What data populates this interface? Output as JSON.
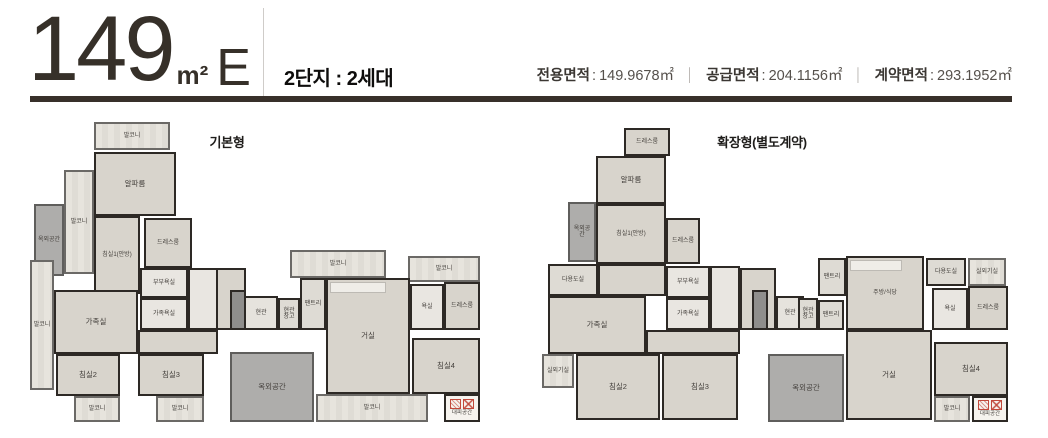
{
  "header": {
    "area_number": "149",
    "area_unit": "m²",
    "type_letter": "E",
    "subtitle": "2단지 : 2세대",
    "colon": ":",
    "divider": "│",
    "area_info": [
      {
        "label": "전용면적",
        "value": "149.9678㎡"
      },
      {
        "label": "공급면적",
        "value": "204.1156㎡"
      },
      {
        "label": "계약면적",
        "value": "293.1952㎡"
      }
    ],
    "accent_color": "#38302a"
  },
  "colors": {
    "wall": "#2d2925",
    "floor": "#d8d4cc",
    "balcony": "#e4e1da",
    "bath": "#e9e6e1",
    "outdoor": "#aeadab",
    "utility": "#dedbd4",
    "shaft": "#8f8e8c",
    "evac_red": "#c2493b"
  },
  "plans": [
    {
      "id": "basic",
      "title": "기본형",
      "x": 30,
      "y": 118,
      "w": 460,
      "h": 312,
      "title_x": 147,
      "title_y": 14,
      "title_w": 100,
      "rooms": [
        {
          "x": 186,
          "y": 150,
          "w": 30,
          "h": 62,
          "type": "floor"
        },
        {
          "x": 108,
          "y": 212,
          "w": 80,
          "h": 24,
          "type": "floor"
        },
        {
          "x": 158,
          "y": 150,
          "w": 30,
          "h": 62,
          "type": "bath"
        },
        {
          "x": 200,
          "y": 172,
          "w": 16,
          "h": 40,
          "type": "shaft"
        },
        {
          "label": "발코니",
          "x": 64,
          "y": 4,
          "w": 76,
          "h": 28,
          "type": "balcony",
          "small": true
        },
        {
          "label": "알파룸",
          "x": 64,
          "y": 34,
          "w": 82,
          "h": 64,
          "type": "floor"
        },
        {
          "label": "발코니",
          "x": 34,
          "y": 52,
          "w": 30,
          "h": 104,
          "type": "balcony",
          "small": true
        },
        {
          "label": "옥외공간",
          "x": 4,
          "y": 86,
          "w": 30,
          "h": 72,
          "type": "outdoor",
          "small": true
        },
        {
          "label": "침실1(안방)",
          "x": 64,
          "y": 98,
          "w": 46,
          "h": 78,
          "type": "floor",
          "small": true
        },
        {
          "label": "드레스룸",
          "x": 114,
          "y": 100,
          "w": 48,
          "h": 50,
          "type": "floor",
          "small": true
        },
        {
          "label": "부부욕실",
          "x": 110,
          "y": 150,
          "w": 48,
          "h": 30,
          "type": "bath",
          "small": true
        },
        {
          "label": "가족욕실",
          "x": 110,
          "y": 180,
          "w": 48,
          "h": 32,
          "type": "bath",
          "small": true
        },
        {
          "label": "가족실",
          "x": 24,
          "y": 172,
          "w": 84,
          "h": 64,
          "type": "floor"
        },
        {
          "label": "발코니",
          "x": 0,
          "y": 142,
          "w": 24,
          "h": 130,
          "type": "balcony",
          "small": true
        },
        {
          "label": "침실2",
          "x": 26,
          "y": 236,
          "w": 64,
          "h": 42,
          "type": "floor"
        },
        {
          "label": "침실3",
          "x": 108,
          "y": 236,
          "w": 66,
          "h": 42,
          "type": "floor"
        },
        {
          "label": "발코니",
          "x": 44,
          "y": 278,
          "w": 46,
          "h": 26,
          "type": "balcony",
          "small": true
        },
        {
          "label": "발코니",
          "x": 126,
          "y": 278,
          "w": 48,
          "h": 26,
          "type": "balcony",
          "small": true
        },
        {
          "label": "현관",
          "x": 214,
          "y": 178,
          "w": 34,
          "h": 34,
          "type": "entry",
          "small": true
        },
        {
          "label": "현관창고",
          "x": 248,
          "y": 180,
          "w": 22,
          "h": 32,
          "type": "utility",
          "small": true
        },
        {
          "label": "팬트리",
          "x": 270,
          "y": 160,
          "w": 26,
          "h": 52,
          "type": "utility",
          "small": true
        },
        {
          "label": "발코니",
          "x": 260,
          "y": 132,
          "w": 96,
          "h": 28,
          "type": "balcony",
          "small": true
        },
        {
          "label": "발코니",
          "x": 378,
          "y": 138,
          "w": 72,
          "h": 26,
          "type": "balcony",
          "small": true
        },
        {
          "label": "욕실",
          "x": 380,
          "y": 166,
          "w": 34,
          "h": 46,
          "type": "bath",
          "small": true
        },
        {
          "label": "드레스룸",
          "x": 414,
          "y": 164,
          "w": 36,
          "h": 48,
          "type": "floor",
          "small": true
        },
        {
          "label": "거실",
          "x": 296,
          "y": 160,
          "w": 84,
          "h": 116,
          "type": "floor",
          "accent": "counter"
        },
        {
          "label": "침실4",
          "x": 382,
          "y": 220,
          "w": 68,
          "h": 56,
          "type": "floor"
        },
        {
          "label": "옥외공간",
          "x": 200,
          "y": 234,
          "w": 84,
          "h": 70,
          "type": "outdoor"
        },
        {
          "label": "발코니",
          "x": 286,
          "y": 276,
          "w": 112,
          "h": 28,
          "type": "balcony",
          "small": true
        },
        {
          "label": "대피공간",
          "x": 414,
          "y": 276,
          "w": 36,
          "h": 28,
          "type": "evac",
          "small": true
        }
      ]
    },
    {
      "id": "extended",
      "title": "확장형(별도계약)",
      "x": 540,
      "y": 118,
      "w": 472,
      "h": 312,
      "title_x": 142,
      "title_y": 14,
      "title_w": 160,
      "rooms": [
        {
          "x": 200,
          "y": 150,
          "w": 36,
          "h": 62,
          "type": "floor"
        },
        {
          "x": 106,
          "y": 212,
          "w": 94,
          "h": 24,
          "type": "floor"
        },
        {
          "x": 170,
          "y": 148,
          "w": 30,
          "h": 64,
          "type": "bath"
        },
        {
          "x": 58,
          "y": 146,
          "w": 68,
          "h": 32,
          "type": "floor"
        },
        {
          "x": 212,
          "y": 172,
          "w": 16,
          "h": 40,
          "type": "shaft"
        },
        {
          "label": "드레스룸",
          "x": 84,
          "y": 10,
          "w": 46,
          "h": 28,
          "type": "floor",
          "small": true
        },
        {
          "label": "알파룸",
          "x": 56,
          "y": 38,
          "w": 70,
          "h": 48,
          "type": "floor"
        },
        {
          "label": "옥외공간",
          "x": 28,
          "y": 84,
          "w": 28,
          "h": 60,
          "type": "outdoor",
          "small": true
        },
        {
          "label": "침실1(안방)",
          "x": 56,
          "y": 86,
          "w": 70,
          "h": 60,
          "type": "floor",
          "small": true
        },
        {
          "label": "드레스룸",
          "x": 126,
          "y": 100,
          "w": 34,
          "h": 46,
          "type": "floor",
          "small": true
        },
        {
          "label": "다용도실",
          "x": 8,
          "y": 146,
          "w": 50,
          "h": 32,
          "type": "utility",
          "small": true
        },
        {
          "label": "부부욕실",
          "x": 126,
          "y": 148,
          "w": 44,
          "h": 32,
          "type": "bath",
          "small": true
        },
        {
          "label": "가족실",
          "x": 8,
          "y": 178,
          "w": 98,
          "h": 58,
          "type": "floor"
        },
        {
          "label": "가족욕실",
          "x": 126,
          "y": 180,
          "w": 44,
          "h": 32,
          "type": "bath",
          "small": true
        },
        {
          "label": "실외기실",
          "x": 2,
          "y": 236,
          "w": 32,
          "h": 34,
          "type": "balcony",
          "small": true
        },
        {
          "label": "침실2",
          "x": 36,
          "y": 236,
          "w": 84,
          "h": 66,
          "type": "floor"
        },
        {
          "label": "침실3",
          "x": 122,
          "y": 236,
          "w": 76,
          "h": 66,
          "type": "floor"
        },
        {
          "label": "현관",
          "x": 236,
          "y": 178,
          "w": 28,
          "h": 34,
          "type": "entry",
          "small": true
        },
        {
          "label": "현관창고",
          "x": 258,
          "y": 180,
          "w": 20,
          "h": 32,
          "type": "utility",
          "small": true
        },
        {
          "label": "팬트리",
          "x": 278,
          "y": 182,
          "w": 26,
          "h": 30,
          "type": "utility",
          "small": true
        },
        {
          "label": "팬트리",
          "x": 278,
          "y": 140,
          "w": 28,
          "h": 38,
          "type": "utility",
          "small": true
        },
        {
          "label": "주방/식당",
          "x": 306,
          "y": 138,
          "w": 78,
          "h": 74,
          "type": "floor",
          "accent": "counter",
          "small": true
        },
        {
          "label": "다용도실",
          "x": 386,
          "y": 140,
          "w": 40,
          "h": 28,
          "type": "utility",
          "small": true
        },
        {
          "label": "실외기실",
          "x": 428,
          "y": 140,
          "w": 38,
          "h": 28,
          "type": "balcony",
          "small": true
        },
        {
          "label": "욕실",
          "x": 392,
          "y": 170,
          "w": 36,
          "h": 42,
          "type": "bath",
          "small": true
        },
        {
          "label": "드레스룸",
          "x": 428,
          "y": 168,
          "w": 40,
          "h": 44,
          "type": "floor",
          "small": true
        },
        {
          "label": "거실",
          "x": 306,
          "y": 212,
          "w": 86,
          "h": 90,
          "type": "floor"
        },
        {
          "label": "침실4",
          "x": 394,
          "y": 224,
          "w": 74,
          "h": 54,
          "type": "floor"
        },
        {
          "label": "옥외공간",
          "x": 228,
          "y": 236,
          "w": 76,
          "h": 68,
          "type": "outdoor"
        },
        {
          "label": "발코니",
          "x": 394,
          "y": 278,
          "w": 36,
          "h": 26,
          "type": "balcony",
          "small": true
        },
        {
          "label": "대피공간",
          "x": 432,
          "y": 278,
          "w": 36,
          "h": 26,
          "type": "evac",
          "small": true
        }
      ]
    }
  ]
}
